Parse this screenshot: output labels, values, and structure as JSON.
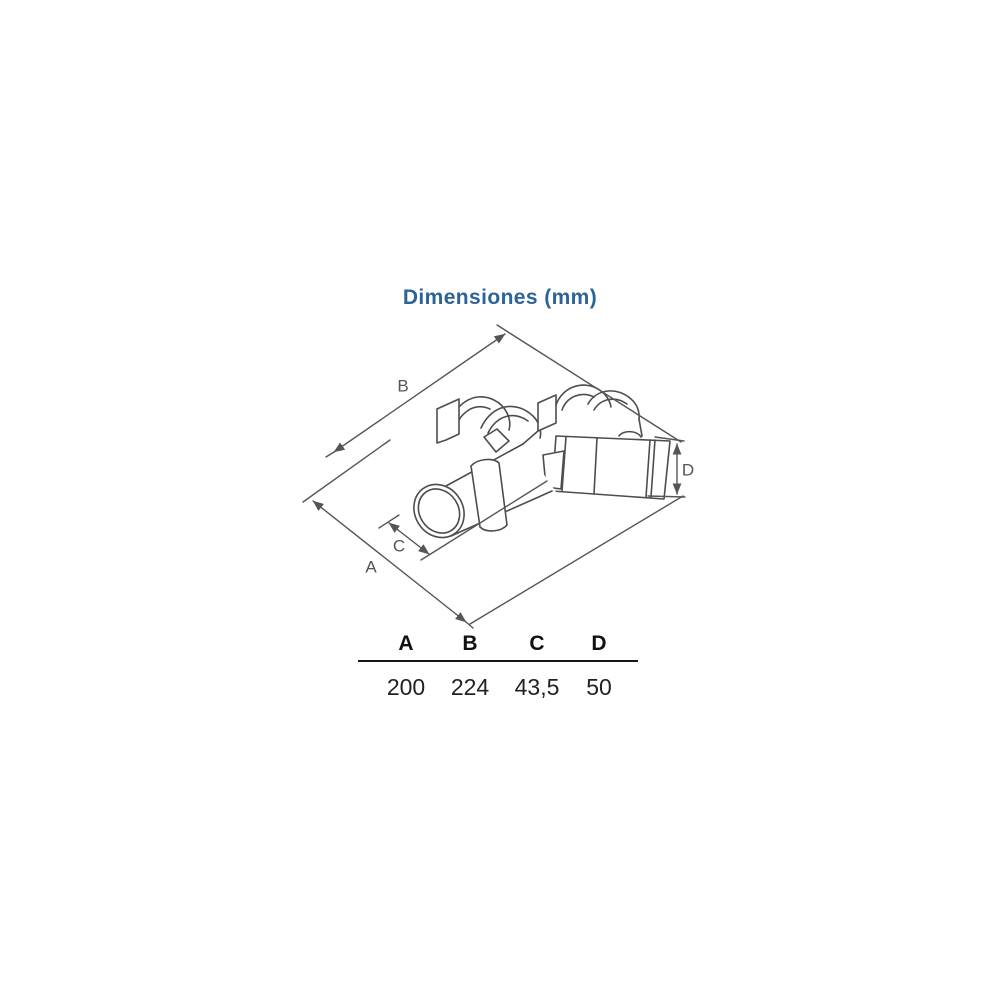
{
  "title": "Dimensiones (mm)",
  "drawing": {
    "labels": {
      "a": "A",
      "b": "B",
      "c": "C",
      "d": "D"
    }
  },
  "table": {
    "headers": [
      "A",
      "B",
      "C",
      "D"
    ],
    "values": [
      "200",
      "224",
      "43,5",
      "50"
    ]
  },
  "colors": {
    "title": "#2d6397",
    "dimension_lines": "#555555",
    "drawing_lines": "#4d4d4d",
    "table_text": "#111111"
  }
}
